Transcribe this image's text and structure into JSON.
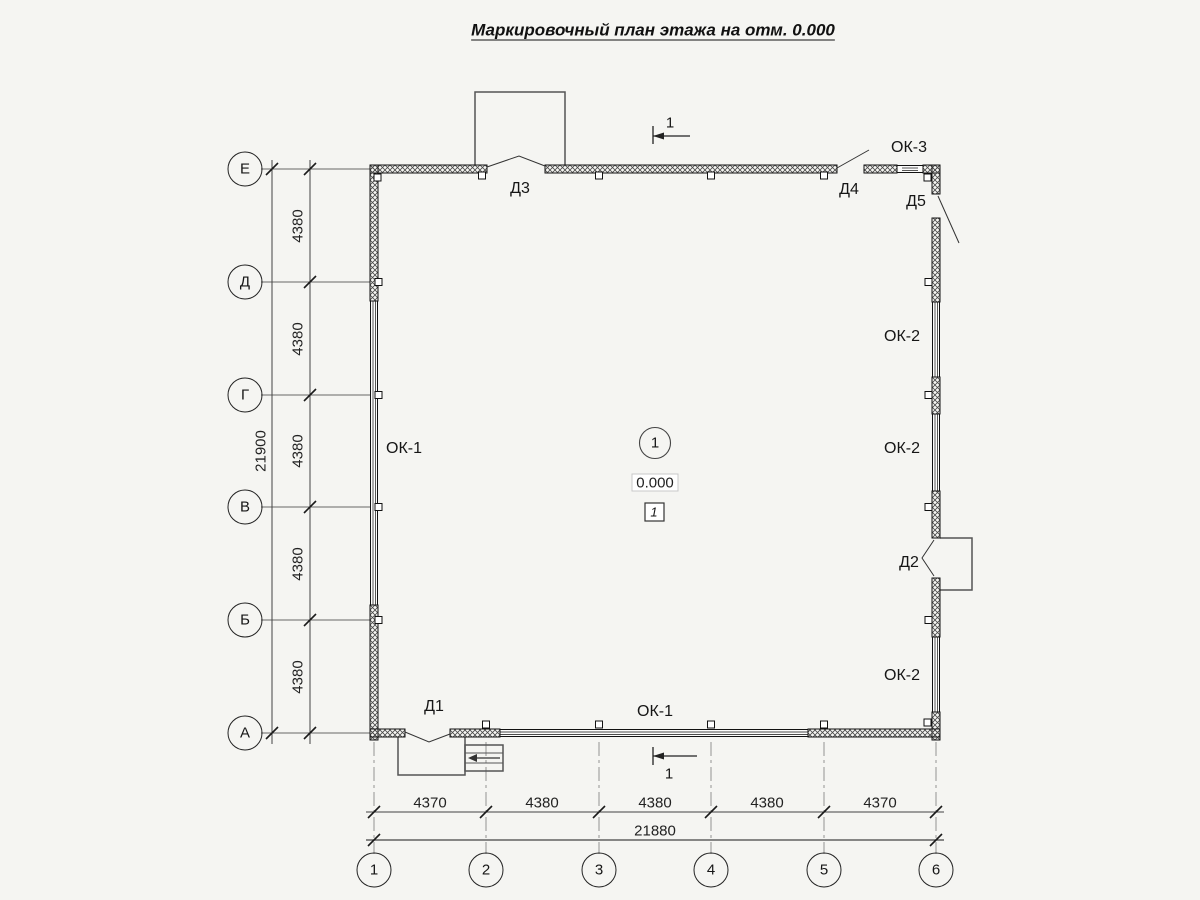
{
  "title": "Маркировочный план этажа на отм. 0.000",
  "axes": {
    "vertical": [
      "Е",
      "Д",
      "Г",
      "В",
      "Б",
      "А"
    ],
    "horizontal": [
      "1",
      "2",
      "3",
      "4",
      "5",
      "6"
    ]
  },
  "dims": {
    "left_segments": [
      "4380",
      "4380",
      "4380",
      "4380",
      "4380"
    ],
    "left_total": "21900",
    "bottom_segments": [
      "4370",
      "4380",
      "4380",
      "4380",
      "4370"
    ],
    "bottom_total": "21880"
  },
  "labels": {
    "door_d1": "Д1",
    "door_d2": "Д2",
    "door_d3": "Д3",
    "door_d4": "Д4",
    "door_d5": "Д5",
    "window_ok1_left": "ОК-1",
    "window_ok1_bottom": "ОК-1",
    "window_ok2_upper": "ОК-2",
    "window_ok2_middle": "ОК-2",
    "window_ok2_lower": "ОК-2",
    "window_ok3": "ОК-3"
  },
  "room": {
    "number": "1",
    "elevation": "0.000",
    "type_tag": "1"
  },
  "section": {
    "top": "1",
    "bottom": "1"
  }
}
